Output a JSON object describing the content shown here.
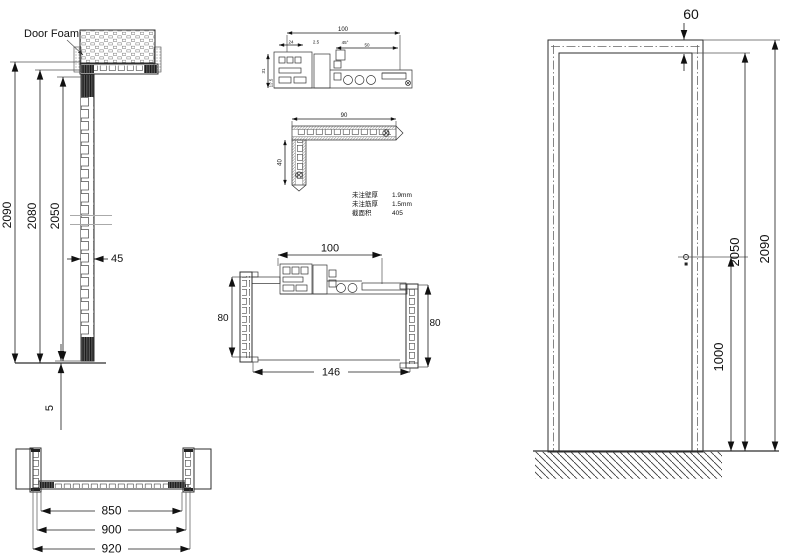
{
  "drawing_title": "Door frame technical drawing",
  "annotations": {
    "door_foam_label": "Door Foam"
  },
  "left_section_view": {
    "overall_height": "2090",
    "frame_height": "2080",
    "door_leaf_height": "2050",
    "leaf_thickness": "45",
    "bottom_gap": "5"
  },
  "head_profile_detail": {
    "width": "100",
    "sub_left": "24",
    "notch": "2.5",
    "angle": "45°",
    "sub_right": "50",
    "height": "31",
    "bottom": "12.5"
  },
  "corner_profile_detail": {
    "width": "90",
    "height": "40",
    "notes": [
      {
        "label": "未注壁厚",
        "value": "1.9mm"
      },
      {
        "label": "未注筋厚",
        "value": "1.5mm"
      },
      {
        "label": "截面积",
        "value": "405"
      }
    ]
  },
  "jamb_plan_section": {
    "head_width": "100",
    "depth_left": "80",
    "depth_right": "80",
    "overall_width": "146"
  },
  "bottom_plan_section": {
    "clear_width": "850",
    "frame_width": "900",
    "overall_width": "920"
  },
  "elevation_view": {
    "head_height": "60",
    "door_height": "2050",
    "overall_height": "2090",
    "handle_height": "1000"
  },
  "colors": {
    "line": "#2e2e2e",
    "dim_text": "#111111",
    "background": "#ffffff"
  }
}
